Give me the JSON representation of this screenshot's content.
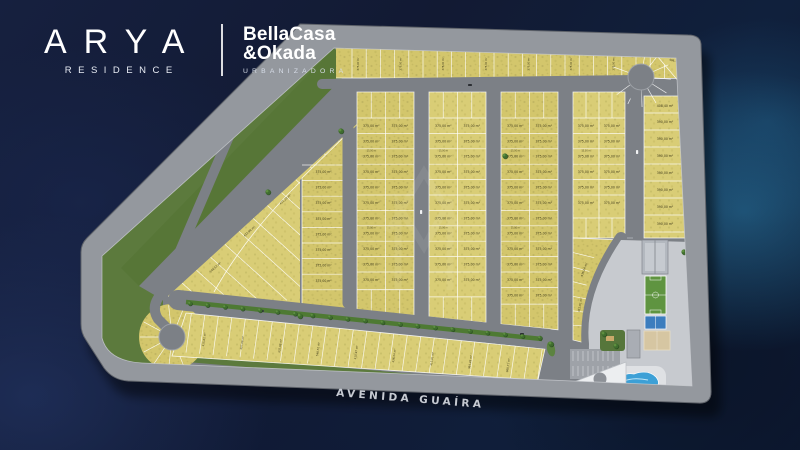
{
  "header": {
    "brand_name": "ARYA",
    "brand_subtitle": "RESIDENCE",
    "developer_line1": "BellaCasa",
    "developer_line2": "&Okada",
    "developer_subtitle": "URBANIZADORA"
  },
  "map": {
    "avenue_label": "AVENIDA GUAÍRA",
    "lot_labels": {
      "default_area": "375,00 m²",
      "right_column_area": "390,00 m²",
      "right_column_head_area": "408,40 m²",
      "corner_areas": [
        "406,71 m²",
        "467,43 m²"
      ],
      "lot_width": "15,00 m",
      "irregular_areas": [
        "364,26 m²",
        "368,71 m²",
        "411,23 m²",
        "415,02 m²",
        "407,06 m²",
        "432,98 m²",
        "548,52 m²",
        "410,97 m²",
        "436,24 m²",
        "412,01 m²"
      ]
    }
  },
  "colors": {
    "background_navy": "#121a33",
    "perimeter_road": "#94989e",
    "inner_road": "#7c8086",
    "lot_yellow": "#d3c66c",
    "lot_yellow_alt": "#dbcf78",
    "green_area": "#5c7a3d",
    "tree_green": "#3f6d2e",
    "field_green": "#5f9440",
    "court_blue": "#3c7dbe",
    "pool_blue": "#3da0d6",
    "sand_tan": "#d6c6a2",
    "lot_text": "#403c1c",
    "avenue_text": "#c6cad2"
  }
}
